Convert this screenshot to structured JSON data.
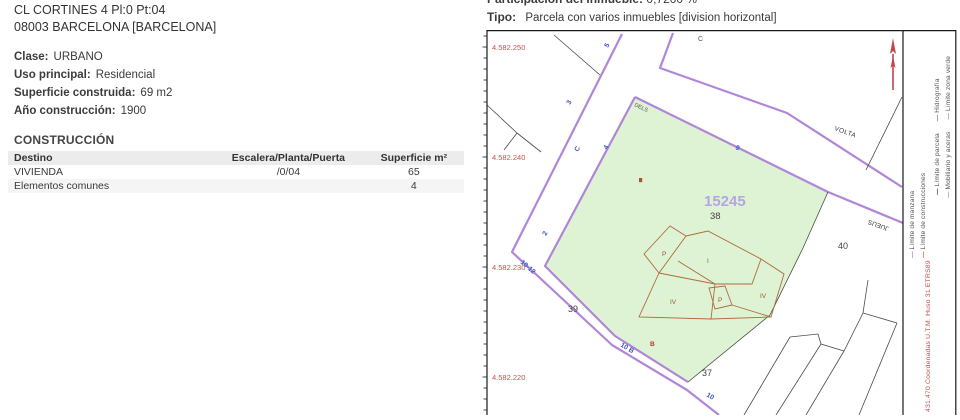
{
  "property": {
    "address_line1": "CL CORTINES 4 Pl:0 Pt:04",
    "address_line2": "08003 BARCELONA [BARCELONA]",
    "fields": [
      {
        "label": "Clase:",
        "value": "URBANO"
      },
      {
        "label": "Uso principal:",
        "value": "Residencial"
      },
      {
        "label": "Superficie construida:",
        "value": "69 m2"
      },
      {
        "label": "Año construcción:",
        "value": "1900"
      }
    ]
  },
  "construction": {
    "title": "CONSTRUCCIÓN",
    "columns": [
      "Destino",
      "Escalera/Planta/Puerta",
      "Superficie m²"
    ],
    "rows": [
      [
        "VIVIENDA",
        "/0/04",
        "65"
      ],
      [
        "Elementos comunes",
        "",
        "4"
      ]
    ]
  },
  "parcel_info": {
    "participation_label": "Participación del inmueble:",
    "participation_value": "0,7200 %",
    "type_label": "Tipo:",
    "type_value": "Parcela con varios inmuebles [division horizontal]"
  },
  "map": {
    "y_labels": [
      "4.582.250",
      "4.582.240",
      "4.582.230",
      "4.582.220"
    ],
    "parcel_number": "15245",
    "block_current": "38",
    "block_left": "39",
    "block_right": "40",
    "block_bottom": "37",
    "street_names": {
      "c_top": "C",
      "dels": "DELS",
      "volta": "VOLTA",
      "jueus": "JUEUS"
    },
    "street_numbers": {
      "s5": "5",
      "s3": "3",
      "sC": "C",
      "s4": "4",
      "s2": "2",
      "s9": "9",
      "s1012": "10-12",
      "s10b": "10 B",
      "s10": "10"
    },
    "construction_labels": {
      "p1": "P",
      "i1": "I",
      "iv1": "IV",
      "p2": "P",
      "iv2": "IV",
      "b1": "B"
    },
    "colors": {
      "parcel_fill": "#def3d3",
      "parcel_border": "#a97fd4",
      "street_line": "#b186d8",
      "construction_line": "#b06a3e",
      "label_blue": "#3c55c6",
      "coordinate_red": "#cf4f4f",
      "parcel_number_violet": "#b4a6e2"
    }
  },
  "legend": {
    "items": [
      {
        "dash": "—",
        "label": "Límite de parcela",
        "color": "#3a3a3a"
      },
      {
        "dash": "—",
        "label": "Hidrografía",
        "color": "#4a6fd4"
      },
      {
        "dash": "—",
        "label": "Mobiliario y aceras",
        "color": "#9a9a9a"
      },
      {
        "dash": "—",
        "label": "Límite zona verde",
        "color": "#63b24b"
      },
      {
        "dash": "—",
        "label": "Límite de manzana",
        "color": "#a977d6"
      },
      {
        "dash": "—",
        "label": "Límite de construcciones",
        "color": "#c0504d"
      }
    ],
    "utm_note": "431.470 Coordenadas U.T.M. Huso 31 ETRS89"
  }
}
